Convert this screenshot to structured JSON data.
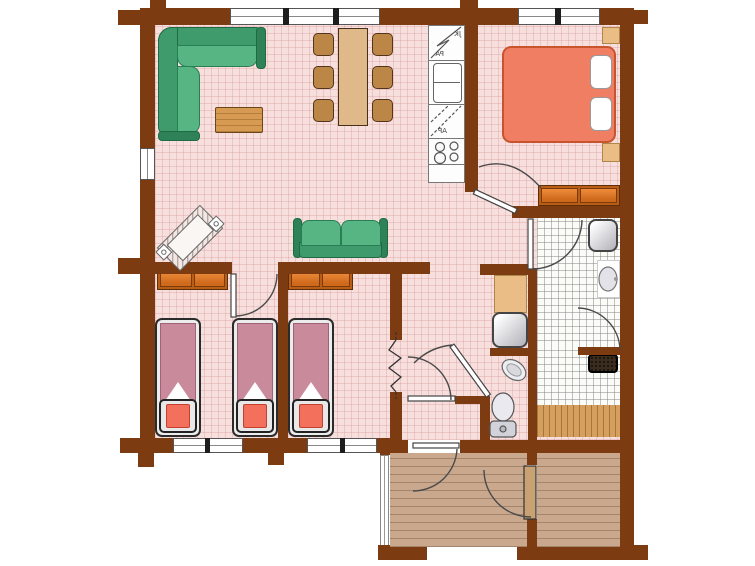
{
  "plan": {
    "kitchen_labels": {
      "top_unit": "JK",
      "top_unit_lower": "PA",
      "mid_unit": "AP"
    },
    "colors": {
      "wall": "#7d3b12",
      "floor_pink": "#f7dfdd",
      "tile": "#fbfbf8",
      "porch_wood": "#c9a88e",
      "sauna_bench_wood": "#d5a05e",
      "sofa_green": "#57b584",
      "double_bed": "#ef7e62",
      "single_bed_mattress": "#c98a9b",
      "single_bed_foot_cushion": "#f2705c",
      "wardrobe_orange": "#cf6a1d",
      "cabinet_tan": "#e9bd85",
      "dining_wood": "#dfb98a"
    }
  }
}
